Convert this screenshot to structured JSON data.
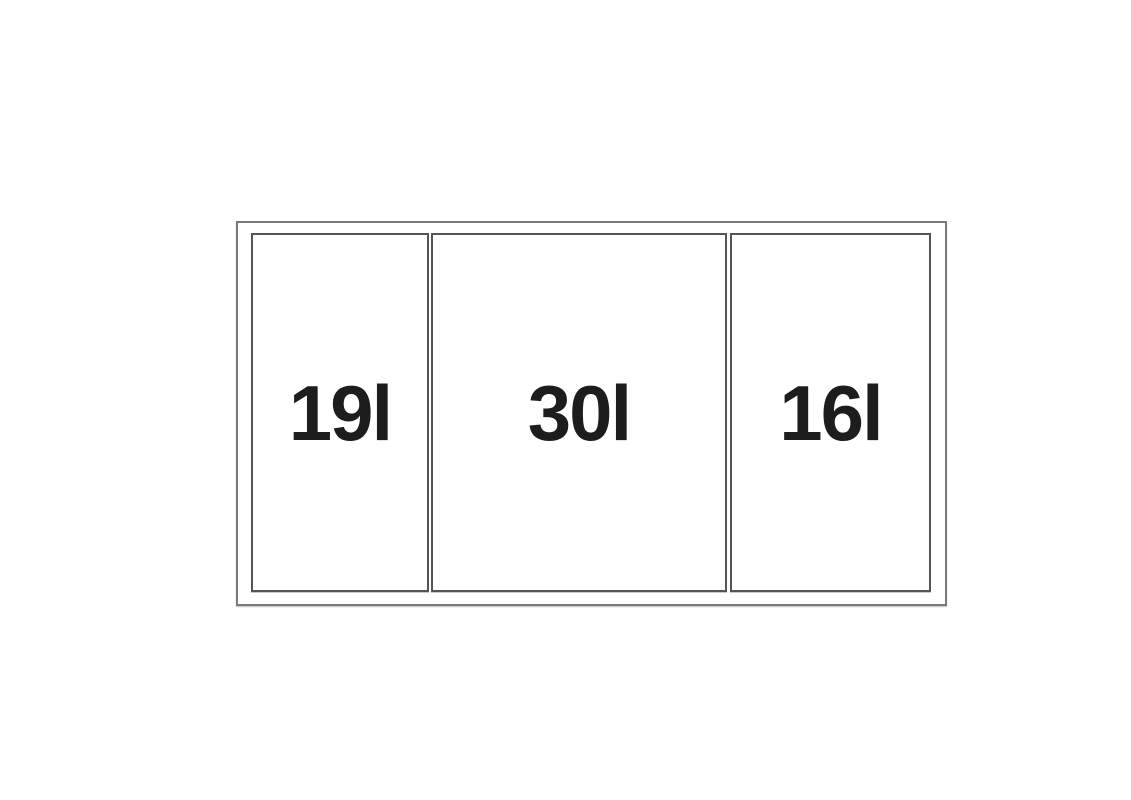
{
  "diagram": {
    "type": "waste-bin-drawer-layout",
    "compartments": [
      {
        "label": "19l",
        "capacity_liters": 19
      },
      {
        "label": "30l",
        "capacity_liters": 30
      },
      {
        "label": "16l",
        "capacity_liters": 16
      }
    ],
    "colors": {
      "background": "#ffffff",
      "outer_border": "#7a7a7a",
      "inner_border": "#555555",
      "label_text": "#1d1d1d"
    }
  }
}
